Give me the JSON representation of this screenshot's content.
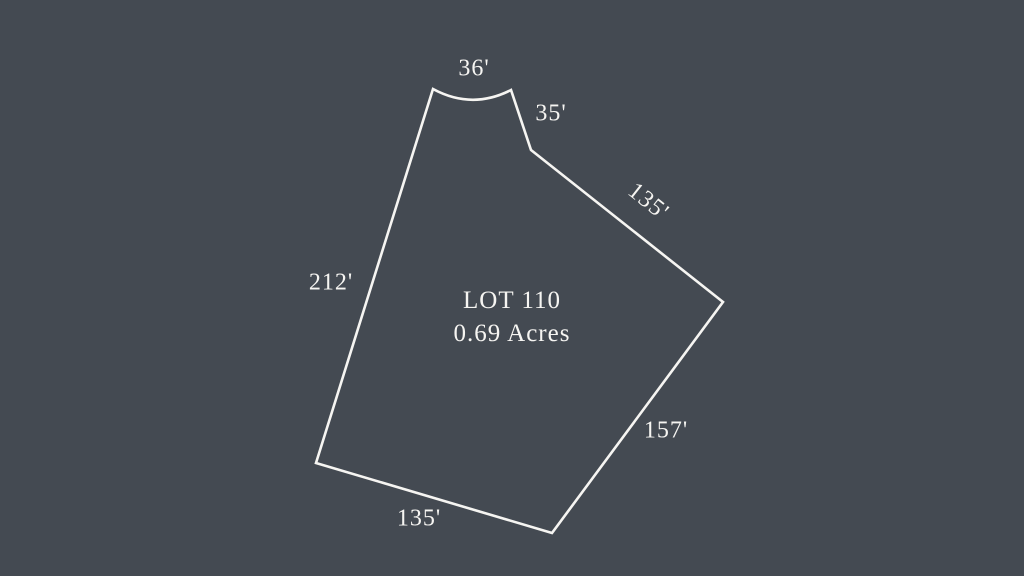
{
  "canvas": {
    "width": 1024,
    "height": 576,
    "background_color": "#444a52",
    "line_color": "#f6f5f2",
    "text_color": "#f6f5f2",
    "line_width": 2.6
  },
  "lot": {
    "name": "LOT 110",
    "area": "0.69 Acres",
    "outline": {
      "curve_start": [
        433,
        89
      ],
      "curve_control": [
        472,
        110
      ],
      "curve_end": [
        511,
        90
      ],
      "points": [
        [
          531,
          150
        ],
        [
          723,
          302
        ],
        [
          552,
          533
        ],
        [
          316,
          463
        ]
      ]
    }
  },
  "dimensions": [
    {
      "text": "36'",
      "x": 474,
      "y": 69,
      "rotation": 0
    },
    {
      "text": "35'",
      "x": 551,
      "y": 114,
      "rotation": 0
    },
    {
      "text": "135'",
      "x": 648,
      "y": 202,
      "rotation": 38.5
    },
    {
      "text": "212'",
      "x": 331,
      "y": 283,
      "rotation": 0
    },
    {
      "text": "157'",
      "x": 666,
      "y": 431,
      "rotation": 0
    },
    {
      "text": "135'",
      "x": 419,
      "y": 519,
      "rotation": 0
    }
  ]
}
